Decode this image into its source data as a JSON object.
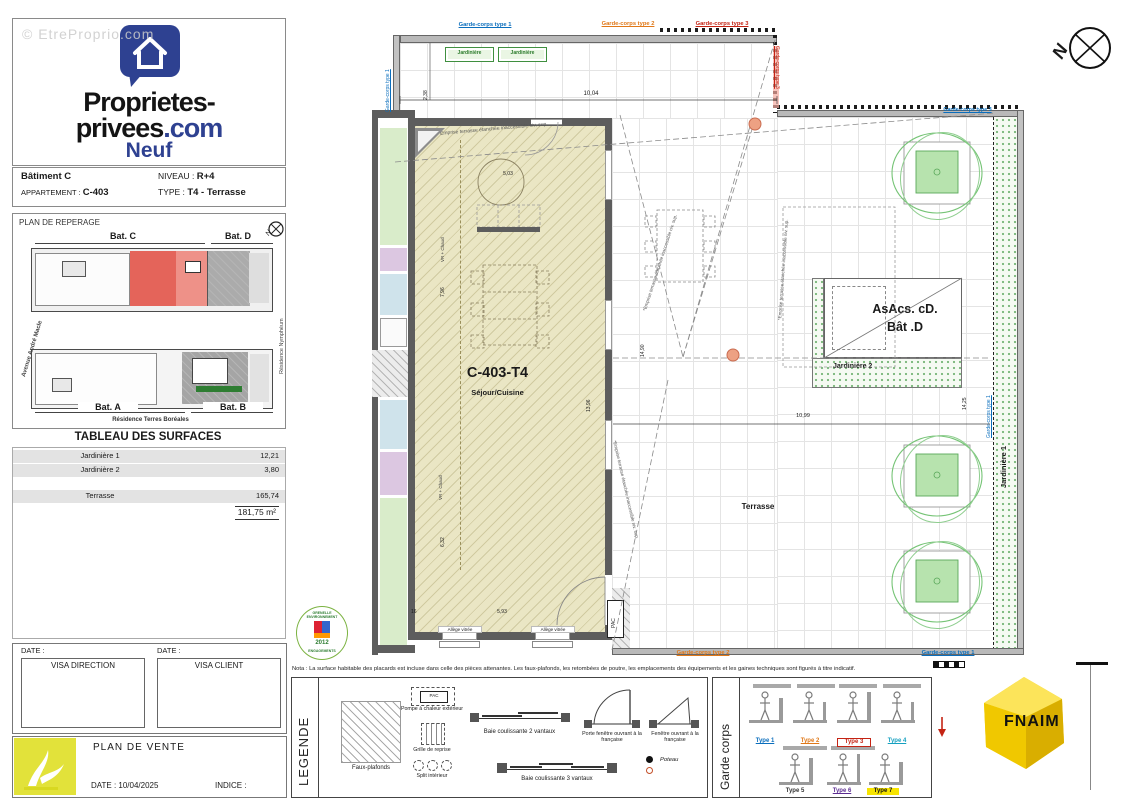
{
  "watermark": "© EtreProprio.com",
  "logo": {
    "line1": "Proprietes-",
    "line2a": "privees",
    "line2b": ".com",
    "line3": "Neuf"
  },
  "info": {
    "batiment": "Bâtiment C",
    "niveau_label": "NIVEAU :",
    "niveau_value": "R+4",
    "appartement_label": "APPARTEMENT :",
    "appartement_value": "C-403",
    "type_label": "TYPE :",
    "type_value": "T4 - Terrasse"
  },
  "reperage": {
    "title": "PLAN DE REPERAGE",
    "bat_a": "Bat. A",
    "bat_b": "Bat. B",
    "bat_c": "Bat. C",
    "bat_d": "Bat. D",
    "street_left": "Avenue André Macle",
    "street_right": "Résidence Nymphéum",
    "street_bottom": "Résidence Terres Boréales"
  },
  "surfaces": {
    "title": "TABLEAU DES SURFACES",
    "rows": [
      {
        "label": "Jardinière 1",
        "value": "12,21"
      },
      {
        "label": "Jardinière 2",
        "value": "3,80"
      },
      {
        "label": "Terrasse",
        "value": "165,74"
      }
    ],
    "total": "181,75 m²"
  },
  "visa": {
    "date_label": "DATE :",
    "direction_label": "VISA DIRECTION",
    "client_label": "VISA CLIENT"
  },
  "plan_vente": {
    "title": "PLAN DE VENTE",
    "date_label": "DATE : 10/04/2025",
    "indice_label": "INDICE :"
  },
  "plan": {
    "unit": "C-403-T4",
    "room": "Séjour/Cuisine",
    "terrasse": "Terrasse",
    "asacs_line1": "AsAcs. cD.",
    "asacs_line2": "Bât .D",
    "jardiniere": "Jardinière",
    "jardiniere1": "Jardinière 1",
    "jardiniere2": "Jardinière 2",
    "gc1": "Garde-corps type 1",
    "gc2": "Garde-corps type 2",
    "gc3": "Garde-corps type 3",
    "emprise": "*Emprise terrasse étanchée inaccessible niv. sup.",
    "chaud": "VR + Chaud",
    "pac": "PAC",
    "allege": "Allège vitrée",
    "dims": {
      "d1": "10,04",
      "d2": "2,38",
      "d3": "5,03",
      "d4": "7,96",
      "d5": "6,32",
      "d6": "13,96",
      "d7": "14,90",
      "d8": "5,93",
      "d9": "16",
      "d10": "10,99",
      "d11": "14,25"
    }
  },
  "nota": "Nota : La surface habitable des placards est incluse dans celle des pièces attenantes. Les faux-plafonds, les retombées de poutre, les emplacements des équipements et les gaines techniques sont figurés à titre indicatif.",
  "legende": {
    "title": "LEGENDE",
    "faux_plafonds": "Faux-plafonds",
    "pac_symbol": "PAC",
    "pompe": "Pompe à chaleur extérieur",
    "grille": "Grille de reprise",
    "split": "Split intérieur",
    "baie2": "Baie coulissante 2 vantaux",
    "porte": "Porte fenêtre ouvrant à la française",
    "fenetre": "Fenêtre ouvrant à la française",
    "baie3": "Baie coulissante 3 vantaux",
    "poteau": "Poteau"
  },
  "garde_corps": {
    "title": "Garde corps",
    "types": [
      "Type 1",
      "Type 2",
      "Type 3",
      "Type 4",
      "Type 5",
      "Type 6",
      "Type 7"
    ]
  },
  "grenelle": {
    "top": "GRENELLE ENVIRONNEMENT",
    "bottom": "ENGAGEMENTS",
    "year": "2012"
  },
  "fnaim": "FNAIM",
  "compass_n": "N",
  "colors": {
    "brand_blue": "#2e4191",
    "fnaim_yellow": "#f7d500",
    "highlight_red": "#e4645a"
  }
}
